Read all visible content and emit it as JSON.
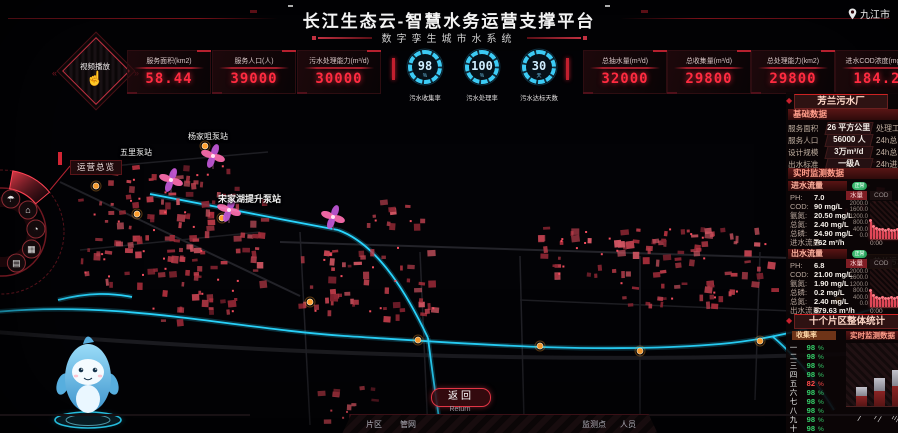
{
  "header": {
    "title": "长江生态云-智慧水务运营支撑平台",
    "subtitle": "数字孪生城市水系统",
    "city": "九江市"
  },
  "topbar": {
    "video_button": "视频播放",
    "stats_left": [
      {
        "label": "服务面积(km2)",
        "value": "58.44"
      },
      {
        "label": "服务人口(人)",
        "value": "39000"
      },
      {
        "label": "污水处理能力(m³/d)",
        "value": "30000"
      }
    ],
    "gauges": [
      {
        "value": "98",
        "unit": "%",
        "label": "污水收集率"
      },
      {
        "value": "100",
        "unit": "%",
        "label": "污水处理率"
      },
      {
        "value": "30",
        "unit": "天",
        "label": "污水达标天数"
      }
    ],
    "stats_right": [
      {
        "label": "总抽水量(m³/d)",
        "value": "32000"
      },
      {
        "label": "总收集量(m³/d)",
        "value": "29800"
      },
      {
        "label": "总处理能力(km2)",
        "value": "29800"
      },
      {
        "label": "进水COD浓度(mg/L)",
        "value": "184.2"
      }
    ]
  },
  "left_menu": {
    "selected": "运营总览",
    "items": [
      {
        "icon": "umbrella-icon",
        "glyph": "☂"
      },
      {
        "icon": "building-icon",
        "glyph": "⌂"
      },
      {
        "icon": "clock-icon",
        "glyph": "◔"
      },
      {
        "icon": "chart-icon",
        "glyph": "▦"
      },
      {
        "icon": "grid-icon",
        "glyph": "▤"
      }
    ]
  },
  "map": {
    "labels": [
      {
        "text": "五里泵站"
      },
      {
        "text": "杨家咀泵站"
      },
      {
        "text": "宋家湖提升泵站"
      },
      {
        "text": "芳兰污水厂"
      }
    ]
  },
  "panel": {
    "title": "芳兰污水厂",
    "basic": {
      "header": "基础数据",
      "rows": [
        {
          "label": "服务面积",
          "value": "26 平方公里",
          "label2": "处理工"
        },
        {
          "label": "服务人口",
          "value": "56000 人",
          "label2": "24h总"
        },
        {
          "label": "设计规模",
          "value": "3万m³/d",
          "label2": "24h总"
        },
        {
          "label": "出水标准",
          "value": "一级A",
          "label2": "24h进水CO"
        }
      ]
    },
    "realtime_header": "实时监测数据",
    "inflow": {
      "title": "进水流量",
      "status": "正常",
      "rows": [
        {
          "label": "PH:",
          "value": "7.0"
        },
        {
          "label": "COD:",
          "value": "90 mg/L"
        },
        {
          "label": "氨氮:",
          "value": "20.50 mg/L"
        },
        {
          "label": "总氮:",
          "value": "2.40 mg/L"
        },
        {
          "label": "总磷:",
          "value": "24.90 mg/L"
        },
        {
          "label": "进水流量:",
          "value": "762 m³/h"
        }
      ],
      "tabs": [
        "水量",
        "COD"
      ],
      "chart": {
        "type": "bar",
        "yticks": [
          "2000.0",
          "1600.0",
          "1200.0",
          "800.0",
          "400.0",
          "0.0"
        ],
        "xticks": [
          "0:00",
          "4:00",
          "8:00"
        ],
        "ymax": 2000,
        "values": [
          950,
          600,
          480,
          420,
          460,
          380,
          420,
          400,
          380,
          430,
          520,
          720,
          1150,
          1600,
          1950
        ]
      }
    },
    "outflow": {
      "title": "出水流量",
      "status": "正常",
      "rows": [
        {
          "label": "PH:",
          "value": "6.8"
        },
        {
          "label": "COD:",
          "value": "21.00 mg/L"
        },
        {
          "label": "氨氮:",
          "value": "1.90 mg/L"
        },
        {
          "label": "总磷:",
          "value": "0.2 mg/L"
        },
        {
          "label": "总氮:",
          "value": "2.40 mg/L"
        },
        {
          "label": "出水流量:",
          "value": "879.63 m³/h"
        }
      ],
      "tabs": [
        "水量",
        "COD"
      ],
      "chart": {
        "type": "bar",
        "yticks": [
          "2000.0",
          "1600.0",
          "1200.0",
          "800.0",
          "400.0",
          "0.0"
        ],
        "xticks": [
          "0:00",
          "4:00",
          "8:00"
        ],
        "ymax": 2000,
        "values": [
          820,
          560,
          460,
          400,
          430,
          380,
          410,
          430,
          410,
          460,
          540,
          780,
          1250,
          1700,
          1960
        ]
      }
    },
    "districts": {
      "header": "十个片区整体统计",
      "rate": {
        "title": "收集率",
        "rows": [
          {
            "name": "一",
            "value": "98",
            "alert": false
          },
          {
            "name": "二",
            "value": "98",
            "alert": false
          },
          {
            "name": "三",
            "value": "98",
            "alert": false
          },
          {
            "name": "四",
            "value": "98",
            "alert": false
          },
          {
            "name": "五",
            "value": "82",
            "alert": true
          },
          {
            "name": "六",
            "value": "98",
            "alert": false
          },
          {
            "name": "七",
            "value": "98",
            "alert": false
          },
          {
            "name": "八",
            "value": "98",
            "alert": false
          },
          {
            "name": "九",
            "value": "98",
            "alert": false
          },
          {
            "name": "十",
            "value": "98",
            "alert": false
          }
        ],
        "unit": "%"
      },
      "monitor": {
        "header": "实时监测数据",
        "type": "bar",
        "categories": [
          "一",
          "二",
          "三",
          "四",
          "五"
        ],
        "values": [
          32,
          46,
          60,
          74,
          90
        ]
      }
    }
  },
  "bottom": {
    "back": "返回",
    "back_en": "Return",
    "tabs": [
      "片区",
      "管网",
      "监测点",
      "人员"
    ]
  },
  "colors": {
    "accent_red": "#c8202e",
    "led_red": "#ff2b40",
    "gauge_blue": "#3fd4ff",
    "ok_green": "#35d06a",
    "alert_red": "#ff4b4b",
    "pipe_cyan": "#29d6ff"
  }
}
